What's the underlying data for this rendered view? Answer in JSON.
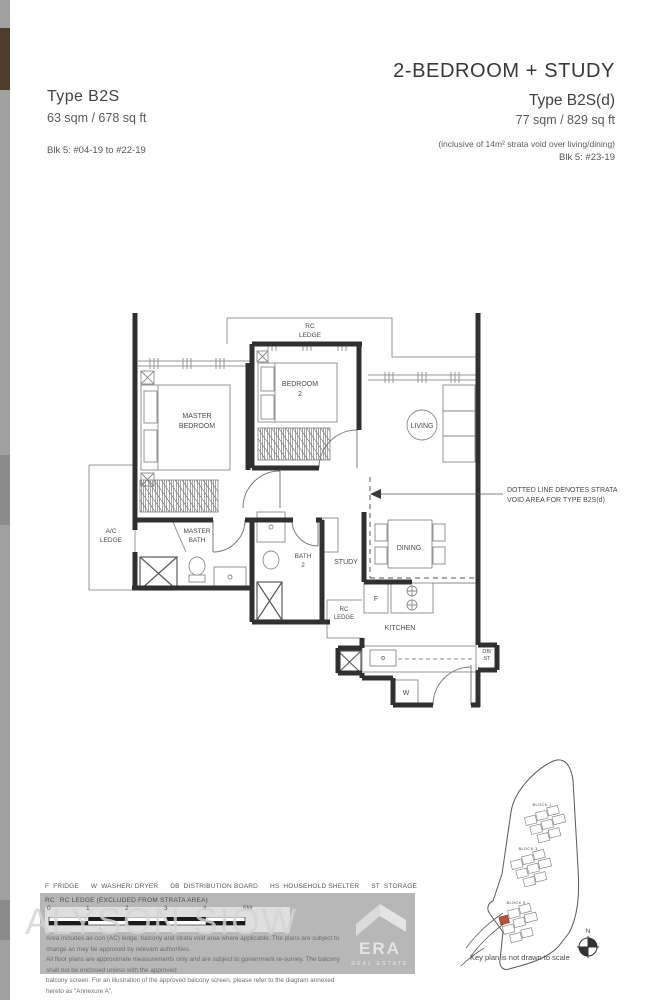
{
  "colors": {
    "wall": "#303030",
    "thin_line": "#979797",
    "label": "#4a4a4a",
    "gray_band": "#b7b7b7",
    "keyplan_highlight": "#b5523c",
    "watermark": "#d4d4d4"
  },
  "header": {
    "left": {
      "type": "Type B2S",
      "area": "63 sqm / 678 sq ft",
      "block": "Blk 5: #04-19 to #22-19"
    },
    "right": {
      "title": "2-BEDROOM + STUDY",
      "type": "Type B2S(d)",
      "area": "77 sqm / 829 sq ft",
      "note": "(inclusive of 14m² strata void over living/dining)",
      "block": "Blk 5: #23-19"
    }
  },
  "fp": {
    "rc_ledge_top": [
      "RC",
      "LEDGE"
    ],
    "master_bedroom": [
      "MASTER",
      "BEDROOM"
    ],
    "bedroom2": [
      "BEDROOM",
      "2"
    ],
    "living": "LIVING",
    "ac_ledge": [
      "A/C",
      "LEDGE"
    ],
    "master_bath": [
      "MASTER",
      "BATH"
    ],
    "bath2": [
      "BATH",
      "2"
    ],
    "study": "STUDY",
    "dining": "DINING",
    "rc_ledge_mid": [
      "RC",
      "LEDGE"
    ],
    "kitchen": "KITCHEN",
    "fridge": "F",
    "washer": "W",
    "db_st": [
      "DB/",
      "ST"
    ],
    "annotation": [
      "DOTTED LINE DENOTES STRATA",
      "VOID AREA FOR TYPE B2S(d)"
    ]
  },
  "legend": {
    "items": [
      {
        "abbr": "F",
        "label": "FRIDGE"
      },
      {
        "abbr": "W",
        "label": "WASHER/ DRYER"
      },
      {
        "abbr": "DB",
        "label": "DISTRIBUTION BOARD"
      },
      {
        "abbr": "HS",
        "label": "HOUSEHOLD SHELTER"
      },
      {
        "abbr": "ST",
        "label": "STORAGE"
      }
    ],
    "rc_abbr": "RC",
    "rc_label": "RC LEDGE (EXCLUDED FROM STRATA AREA)"
  },
  "scalebar": {
    "ticks": [
      "0",
      "1",
      "2",
      "3",
      "4"
    ],
    "end": "5M"
  },
  "disclaimer": {
    "line1": "Area includes air-con (AC) ledge, balcony and strata void area where applicable. The plans are subject to change as may be approved by relevant authorities.",
    "line2": "All floor plans are approximate measurements only and are subject to government re-survey. The balcony shall not be enclosed unless with the approved",
    "line3": "balcony screen. For an illustration of the approved balcony screen, please refer to the diagram annexed hereto as \"Annexure A\"."
  },
  "watermark": {
    "agent": "ALYSON SIOW",
    "brand": "ERA",
    "brand_sub": "REAL ESTATE"
  },
  "keyplan": {
    "blocks": [
      "BLOCK 1",
      "BLOCK 3",
      "BLOCK 5"
    ],
    "caption": "Key plan is not drawn to scale",
    "north": "N"
  }
}
